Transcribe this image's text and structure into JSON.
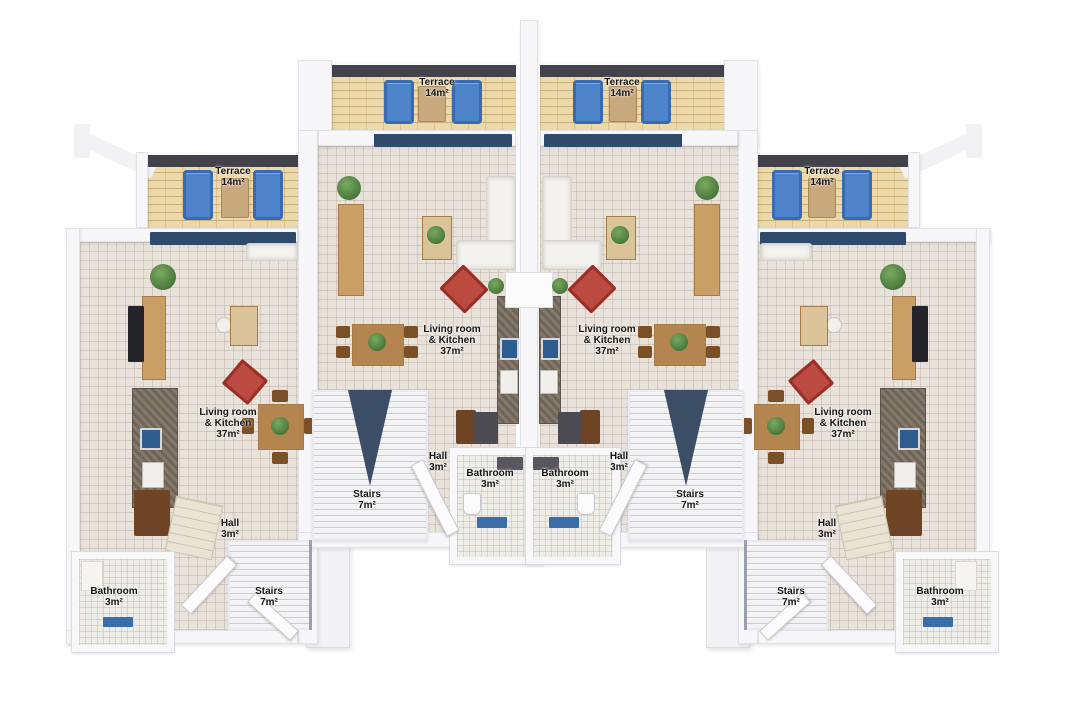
{
  "plan": {
    "view": "3D top-down floor plan of four attached units",
    "palette": {
      "background": "#ffffff",
      "walls": "#f7f7f9",
      "floor_tile": "#e8e2da",
      "terrace_floor": "#ecd9a9",
      "parapet_dark": "#43414a",
      "window_navy": "#2f4a6b",
      "lounger_blue": "#4d83c9",
      "armchair_red": "#bb4a40",
      "wood": "#c99f66",
      "granite_counter": "#7b7164",
      "sink_blue": "#2d5c8e",
      "plant_green": "#5c8f4b",
      "stair_wedge_navy": "#3c4d66",
      "bath_mat_blue": "#3a6ea8"
    }
  },
  "units": [
    {
      "id": "outer-left",
      "rooms": {
        "terrace": {
          "lines": [
            "Terrace",
            "14m²"
          ]
        },
        "living": {
          "lines": [
            "Living room",
            "& Kitchen",
            "37m²"
          ]
        },
        "hall": {
          "lines": [
            "Hall",
            "3m²"
          ]
        },
        "bathroom": {
          "lines": [
            "Bathroom",
            "3m²"
          ]
        },
        "stairs": {
          "lines": [
            "Stairs",
            "7m²"
          ]
        }
      }
    },
    {
      "id": "inner-left",
      "rooms": {
        "terrace": {
          "lines": [
            "Terrace",
            "14m²"
          ]
        },
        "living": {
          "lines": [
            "Living room",
            "& Kitchen",
            "37m²"
          ]
        },
        "hall": {
          "lines": [
            "Hall",
            "3m²"
          ]
        },
        "bathroom": {
          "lines": [
            "Bathroom",
            "3m²"
          ]
        },
        "stairs": {
          "lines": [
            "Stairs",
            "7m²"
          ]
        }
      }
    },
    {
      "id": "inner-right",
      "rooms": {
        "terrace": {
          "lines": [
            "Terrace",
            "14m²"
          ]
        },
        "living": {
          "lines": [
            "Living room",
            "& Kitchen",
            "37m²"
          ]
        },
        "hall": {
          "lines": [
            "Hall",
            "3m²"
          ]
        },
        "bathroom": {
          "lines": [
            "Bathroom",
            "3m²"
          ]
        },
        "stairs": {
          "lines": [
            "Stairs",
            "7m²"
          ]
        }
      }
    },
    {
      "id": "outer-right",
      "rooms": {
        "terrace": {
          "lines": [
            "Terrace",
            "14m²"
          ]
        },
        "living": {
          "lines": [
            "Living room",
            "& Kitchen",
            "37m²"
          ]
        },
        "hall": {
          "lines": [
            "Hall",
            "3m²"
          ]
        },
        "bathroom": {
          "lines": [
            "Bathroom",
            "3m²"
          ]
        },
        "stairs": {
          "lines": [
            "Stairs",
            "7m²"
          ]
        }
      }
    }
  ]
}
